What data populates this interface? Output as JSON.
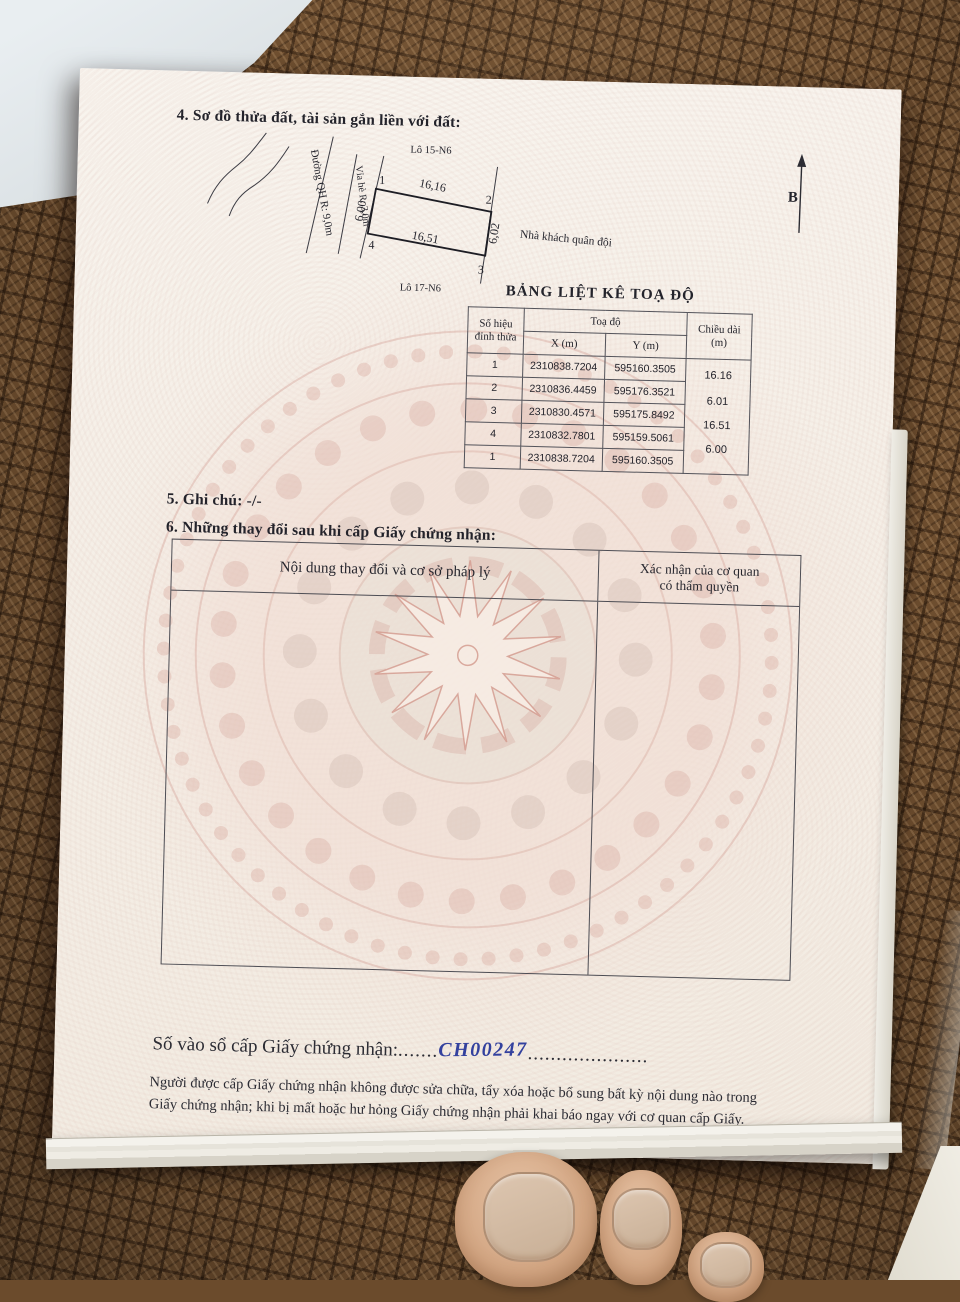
{
  "document": {
    "section4_title": "4. Sơ đồ thửa đất, tài sản gắn liền với đất:",
    "section5_note": "5. Ghi chú: -/-",
    "section6_title": "6. Những thay đổi sau khi cấp Giấy chứng nhận:",
    "registry": {
      "label": "Số vào sổ cấp Giấy chứng nhận:",
      "dots_before": ".......",
      "number": "CH00247",
      "dots_after": "....................."
    },
    "footer_line1": "Người được cấp Giấy chứng nhận không được sửa chữa, tẩy xóa hoặc bổ sung bất kỳ nội dung nào trong",
    "footer_line2": "Giấy chứng nhận; khi bị mất hoặc hư hỏng Giấy chứng nhận phải khai báo ngay với cơ quan cấp Giấy."
  },
  "diagram": {
    "lot_above_label": "Lô 15-N6",
    "lot_below_label": "Lô 17-N6",
    "road_label": "Đường QH R: 9,0m",
    "sidewalk_label": "Vỉa hè R: 3,0m",
    "neighbor_label": "Nhà khách quân đội",
    "north_label": "B",
    "corner_labels": [
      "1",
      "2",
      "3",
      "4"
    ],
    "edge_lengths": {
      "top": "16,16",
      "right": "6,02",
      "bottom": "16,51",
      "left": "6,00"
    }
  },
  "coordinate_table": {
    "title": "BẢNG LIỆT KÊ TOẠ ĐỘ",
    "header": {
      "point_id": "Số hiệu đỉnh thửa",
      "coords_group": "Toạ độ",
      "x": "X (m)",
      "y": "Y (m)",
      "length_line1": "Chiều dài",
      "length_line2": "(m)"
    },
    "rows": [
      {
        "point": "1",
        "x": "2310838.7204",
        "y": "595160.3505"
      },
      {
        "point": "2",
        "x": "2310836.4459",
        "y": "595176.3521"
      },
      {
        "point": "3",
        "x": "2310830.4571",
        "y": "595175.8492"
      },
      {
        "point": "4",
        "x": "2310832.7801",
        "y": "595159.5061"
      },
      {
        "point": "1",
        "x": "2310838.7204",
        "y": "595160.3505"
      }
    ],
    "segment_lengths": [
      "16.16",
      "6.01",
      "16.51",
      "6.00"
    ]
  },
  "changes_table": {
    "content_header": "Nội dung thay đổi và cơ sở pháp lý",
    "authority_header_line1": "Xác nhận của cơ quan",
    "authority_header_line2": "có thẩm quyền"
  },
  "colors": {
    "handwriting_ink": "#33419e",
    "paper": "#f5efe7",
    "mat_brown": "#6e4e2f",
    "watermark_pink": "#d8a89e"
  }
}
